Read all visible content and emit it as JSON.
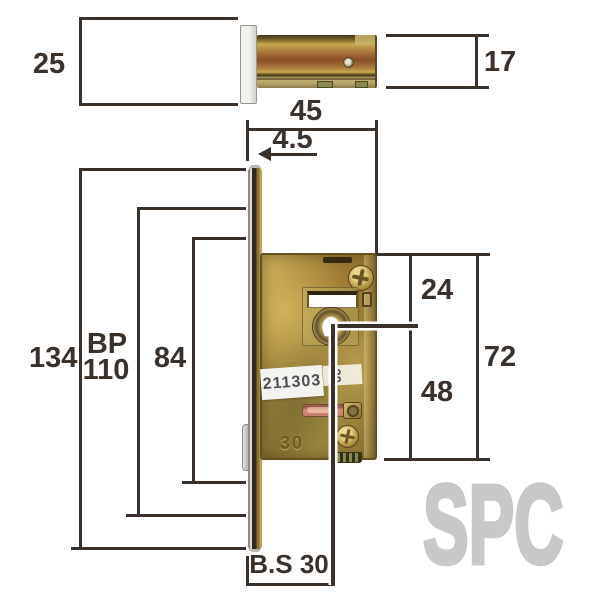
{
  "dims": {
    "plate_width": "25",
    "case_thickness": "17",
    "case_depth": "45",
    "faceplate_thickness": "4.5",
    "faceplate_height": "134",
    "bp_label": "BP",
    "bp_value": "110",
    "inner_spacing": "84",
    "top_to_center": "24",
    "case_height": "72",
    "center_to_bottom": "48",
    "backset": "B.S 30"
  },
  "lock": {
    "serial": "211303",
    "side_sticker": "30",
    "stamp": "30"
  },
  "watermark": "SPC",
  "colors": {
    "dimension_line": "#3a312a",
    "brass": "#b3923f",
    "faceplate_white": "#eceae6",
    "latch_slot": "#cc8372",
    "watermark_gray": "#c8c8c8"
  }
}
